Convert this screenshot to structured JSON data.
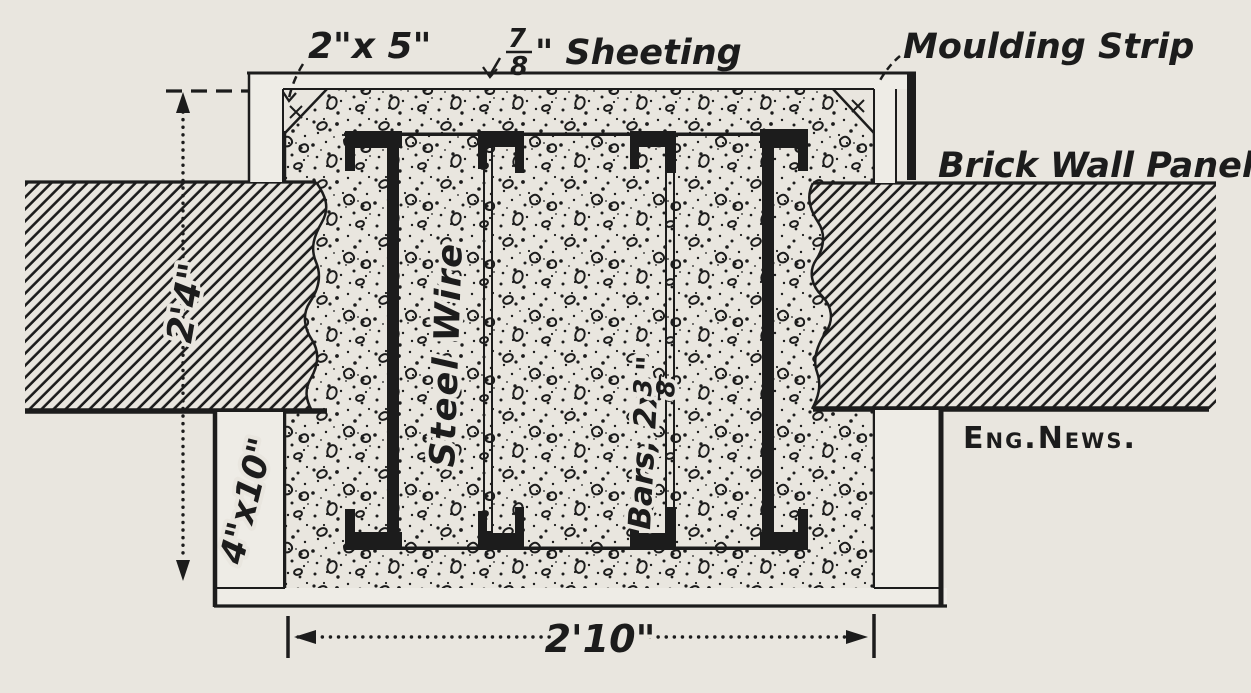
{
  "drawing": {
    "labels": {
      "form_top": "2\"x 5\"",
      "sheeting_num": "7",
      "sheeting_den": "8",
      "sheeting_text": "\" Sheeting",
      "moulding": "Moulding Strip",
      "brick": "Brick Wall Panel",
      "steel_wire": "Steel Wire",
      "bars_prefix": "Bars, 2x",
      "bars_num": "3",
      "bars_den": "8",
      "bars_suffix": "\"",
      "form_bottom": "4\"x10\"",
      "credit": "Eng.News."
    },
    "dimensions": {
      "height": "2'4\"",
      "width": "2'10\""
    },
    "colors": {
      "paper": "#e9e6df",
      "ink": "#1c1c1c"
    }
  }
}
